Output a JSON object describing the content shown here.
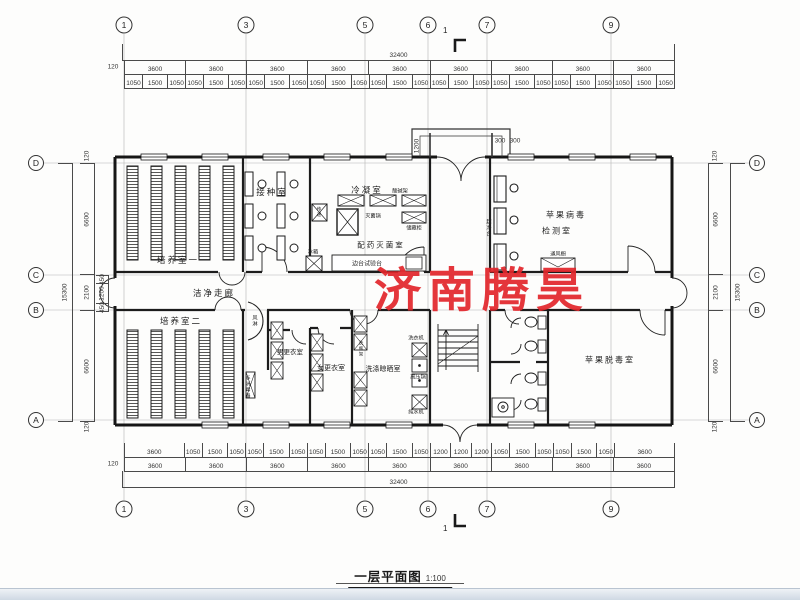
{
  "title": {
    "text": "一层平面图",
    "scale": "1:100"
  },
  "watermark": "济南腾昊",
  "section": {
    "top": "1",
    "bottom": "1"
  },
  "grid": {
    "top": [
      "1",
      "3",
      "5",
      "6",
      "7",
      "9"
    ],
    "bottom": [
      "1",
      "3",
      "5",
      "6",
      "7",
      "9"
    ],
    "left": [
      "D",
      "C",
      "B",
      "A"
    ],
    "right": [
      "D",
      "C",
      "B",
      "A"
    ]
  },
  "dims": {
    "top_total": "32400",
    "bottom_total": "32400",
    "left_total": "15300",
    "right_total": "15300",
    "offset": "120",
    "bays": [
      "3600",
      "3600",
      "3600",
      "3600",
      "3600",
      "3600",
      "3600",
      "3600",
      "3600"
    ],
    "top_windows": [
      "1050",
      "1500",
      "1050",
      "1050",
      "1500",
      "1050",
      "1050",
      "1500",
      "1050",
      "1050",
      "1500",
      "1050",
      "1050",
      "1500",
      "1050",
      "1050",
      "1500",
      "1050",
      "1050",
      "1500",
      "1050",
      "1050",
      "1500",
      "1050",
      "1050",
      "1500",
      "1050"
    ],
    "bottom_mixed": [
      "3600",
      "1050",
      "1500",
      "1050",
      "1050",
      "1500",
      "1050",
      "1050",
      "1500",
      "1050",
      "1050",
      "1500",
      "1050",
      "1200",
      "1200",
      "1200",
      "1050",
      "1500",
      "1050",
      "1050",
      "1500",
      "1050",
      "3600"
    ],
    "side_bays": [
      "6600",
      "2100",
      "6600"
    ],
    "corridor_sub": [
      "450",
      "1200",
      "450"
    ],
    "entrance": {
      "depth": "1200",
      "w1": "300",
      "w2": "300"
    }
  },
  "rooms": {
    "peiyang1": "培养室一",
    "jiezhong": "接种室",
    "lengning": "冷凝室",
    "peiyao": "配药灭菌室",
    "jiance_l1": "苹果病毒",
    "jiance_l2": "检测室",
    "zoulang": "洁净走廊",
    "peiyang2": "培养室二",
    "nangeng": "男更衣室",
    "nugeng": "女更衣室",
    "xidi": "洗涤晾晒室",
    "tuodu": "苹果脱毒室"
  },
  "fixtures": {
    "miejunguo": "灭菌锅",
    "suanjianjia": "酸碱架",
    "chucanggui": "储藏柜",
    "biantai": "边台试验台",
    "bingxiang": "冰箱",
    "chuandi": "传递",
    "chaojingtai": "超净台",
    "tongfengchu": "通风橱",
    "fenglin": "风淋",
    "shouxiaodu": "手消毒器",
    "xiyiji": "洗衣机",
    "gaoyaguo": "高压锅",
    "chunshuiji": "纯水机",
    "xipingjia": "洗瓶架"
  }
}
